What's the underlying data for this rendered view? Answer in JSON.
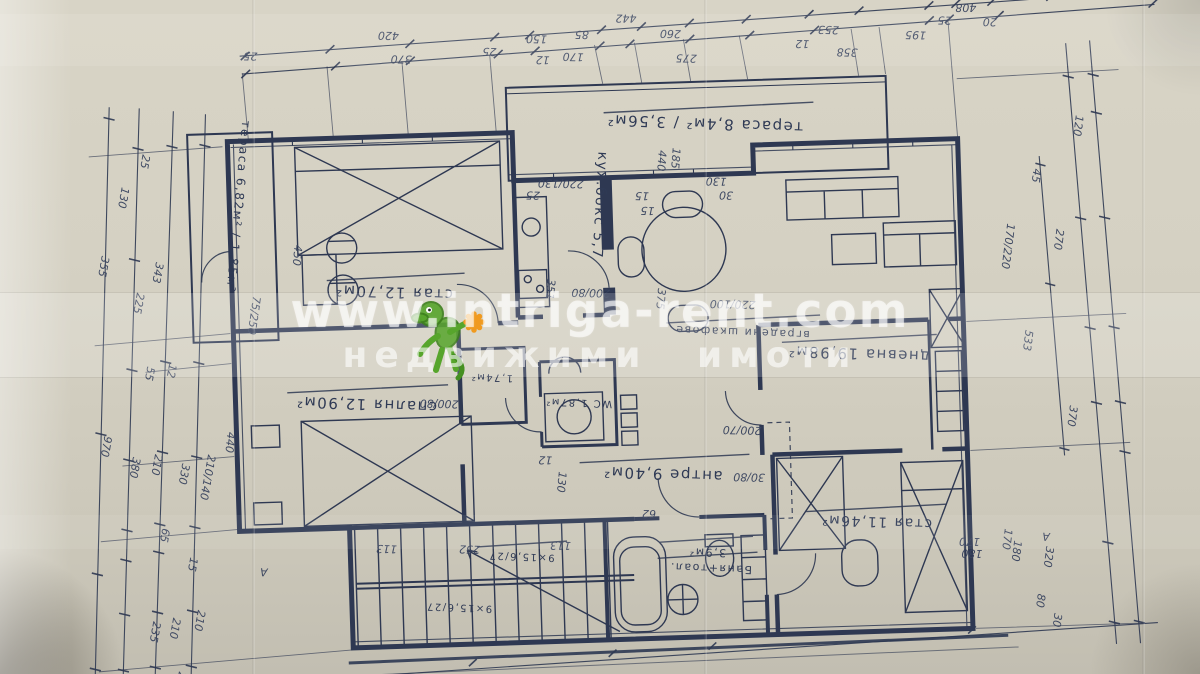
{
  "watermark": {
    "url": "www.intriga-rent.com",
    "tagline": "недвижими имоти",
    "logo_green": "#4f9d2f",
    "logo_orange": "#f09a1f",
    "text_color": "rgba(255,255,255,0.62)"
  },
  "rooms": {
    "terrace_top": {
      "label": "тераса 8,4м² / 3,56м²"
    },
    "terrace_left": {
      "label": "тераса 6,82м² / 1,85м²"
    },
    "room_upper_left": {
      "label": "стая 12,70м²"
    },
    "bedroom_left": {
      "label": "спалня 12,90м²"
    },
    "kitchen": {
      "label": "кух.бокс 5,7"
    },
    "living": {
      "label": "дневна 19,98м²"
    },
    "hall": {
      "label": "антре 9,40м²"
    },
    "wc": {
      "label": "WC 1,87м²"
    },
    "closet": {
      "label": "1,74м²"
    },
    "bath": {
      "area": "3,9м²",
      "label": "Баня+тоал."
    },
    "room_bottom_right": {
      "label": "стая 11,46м²"
    },
    "wardrobe": {
      "label": "вградени шкафове"
    },
    "stairs_upper": {
      "label": "9×15,6/27"
    },
    "stairs_lower": {
      "label": "9×15,6/27"
    }
  },
  "dimensions": {
    "labels": [
      [
        "442",
        648,
        16,
        182,
        12
      ],
      [
        "420",
        410,
        26,
        183,
        12
      ],
      [
        "25",
        268,
        42,
        183,
        10
      ],
      [
        "370",
        422,
        50,
        183,
        12
      ],
      [
        "25",
        507,
        45,
        183,
        10
      ],
      [
        "150",
        558,
        34,
        183,
        11
      ],
      [
        "85",
        600,
        31,
        183,
        11
      ],
      [
        "170",
        594,
        53,
        183,
        11
      ],
      [
        "12",
        560,
        55,
        183,
        9
      ],
      [
        "260",
        692,
        33,
        183,
        11
      ],
      [
        "275",
        707,
        58,
        183,
        11
      ],
      [
        "12",
        820,
        47,
        183,
        9
      ],
      [
        "253",
        850,
        34,
        183,
        11
      ],
      [
        "358",
        868,
        57,
        183,
        11
      ],
      [
        "195",
        937,
        42,
        183,
        11
      ],
      [
        "25",
        963,
        28,
        183,
        10
      ],
      [
        "408",
        988,
        16,
        182,
        12
      ],
      [
        "20",
        1008,
        31,
        183,
        10
      ],
      [
        "25",
        150,
        140,
        102,
        11
      ],
      [
        "130",
        128,
        172,
        102,
        11
      ],
      [
        "355",
        106,
        240,
        102,
        12
      ],
      [
        "343",
        160,
        248,
        102,
        12
      ],
      [
        "225",
        140,
        278,
        102,
        11
      ],
      [
        "55",
        148,
        352,
        102,
        11
      ],
      [
        "12",
        170,
        350,
        102,
        9
      ],
      [
        "970",
        103,
        420,
        102,
        12
      ],
      [
        "380",
        131,
        442,
        102,
        11
      ],
      [
        "210",
        153,
        440,
        102,
        11
      ],
      [
        "330",
        180,
        450,
        102,
        11
      ],
      [
        "210/140",
        206,
        442,
        102,
        10
      ],
      [
        "65",
        158,
        514,
        102,
        11
      ],
      [
        "15",
        185,
        544,
        102,
        10
      ],
      [
        "210",
        191,
        597,
        102,
        11
      ],
      [
        "210",
        166,
        604,
        102,
        11
      ],
      [
        "235",
        146,
        607,
        102,
        11
      ],
      [
        "25",
        170,
        658,
        102,
        10
      ],
      [
        "А",
        262,
        558,
        184,
        12
      ],
      [
        "120",
        1084,
        130,
        99,
        11
      ],
      [
        "45",
        1040,
        182,
        99,
        11
      ],
      [
        "270",
        1061,
        243,
        99,
        12
      ],
      [
        "170/220",
        1012,
        236,
        99,
        10
      ],
      [
        "533",
        1027,
        343,
        99,
        12
      ],
      [
        "370",
        1069,
        420,
        99,
        12
      ],
      [
        "320",
        1041,
        560,
        99,
        11
      ],
      [
        "180",
        1009,
        553,
        99,
        11
      ],
      [
        "80",
        1031,
        607,
        99,
        10
      ],
      [
        "30",
        1047,
        627,
        99,
        10
      ],
      [
        "170",
        1000,
        541,
        99,
        10
      ],
      [
        "А",
        1045,
        547,
        184,
        12
      ],
      [
        "440",
        666,
        152,
        96,
        10
      ],
      [
        "185",
        680,
        150,
        96,
        10
      ],
      [
        "220/130",
        590,
        180,
        183,
        9
      ],
      [
        "130",
        733,
        182,
        183,
        9
      ],
      [
        "30",
        739,
        196,
        183,
        9
      ],
      [
        "25",
        546,
        190,
        183,
        9
      ],
      [
        "15",
        655,
        194,
        183,
        9
      ],
      [
        "15",
        660,
        209,
        183,
        9
      ],
      [
        "200/80",
        613,
        290,
        183,
        10
      ],
      [
        "351",
        551,
        277,
        97,
        10
      ],
      [
        "375",
        661,
        290,
        97,
        10
      ],
      [
        "75/250",
        256,
        285,
        100,
        10
      ],
      [
        "450",
        299,
        235,
        97,
        10
      ],
      [
        "440",
        226,
        420,
        97,
        10
      ],
      [
        "200/80",
        458,
        396,
        183,
        10
      ],
      [
        "200/70",
        760,
        432,
        183,
        10
      ],
      [
        "30/80",
        762,
        479,
        183,
        10
      ],
      [
        "220/100",
        758,
        306,
        183,
        10
      ],
      [
        "12",
        550,
        455,
        183,
        9
      ],
      [
        "130",
        556,
        470,
        97,
        10
      ],
      [
        "62",
        652,
        512,
        183,
        9
      ],
      [
        "252",
        475,
        542,
        183,
        10
      ],
      [
        "113",
        392,
        539,
        183,
        10
      ],
      [
        "113",
        566,
        541,
        183,
        10
      ],
      [
        "170",
        975,
        550,
        183,
        10
      ],
      [
        "180",
        977,
        562,
        183,
        10
      ]
    ]
  }
}
